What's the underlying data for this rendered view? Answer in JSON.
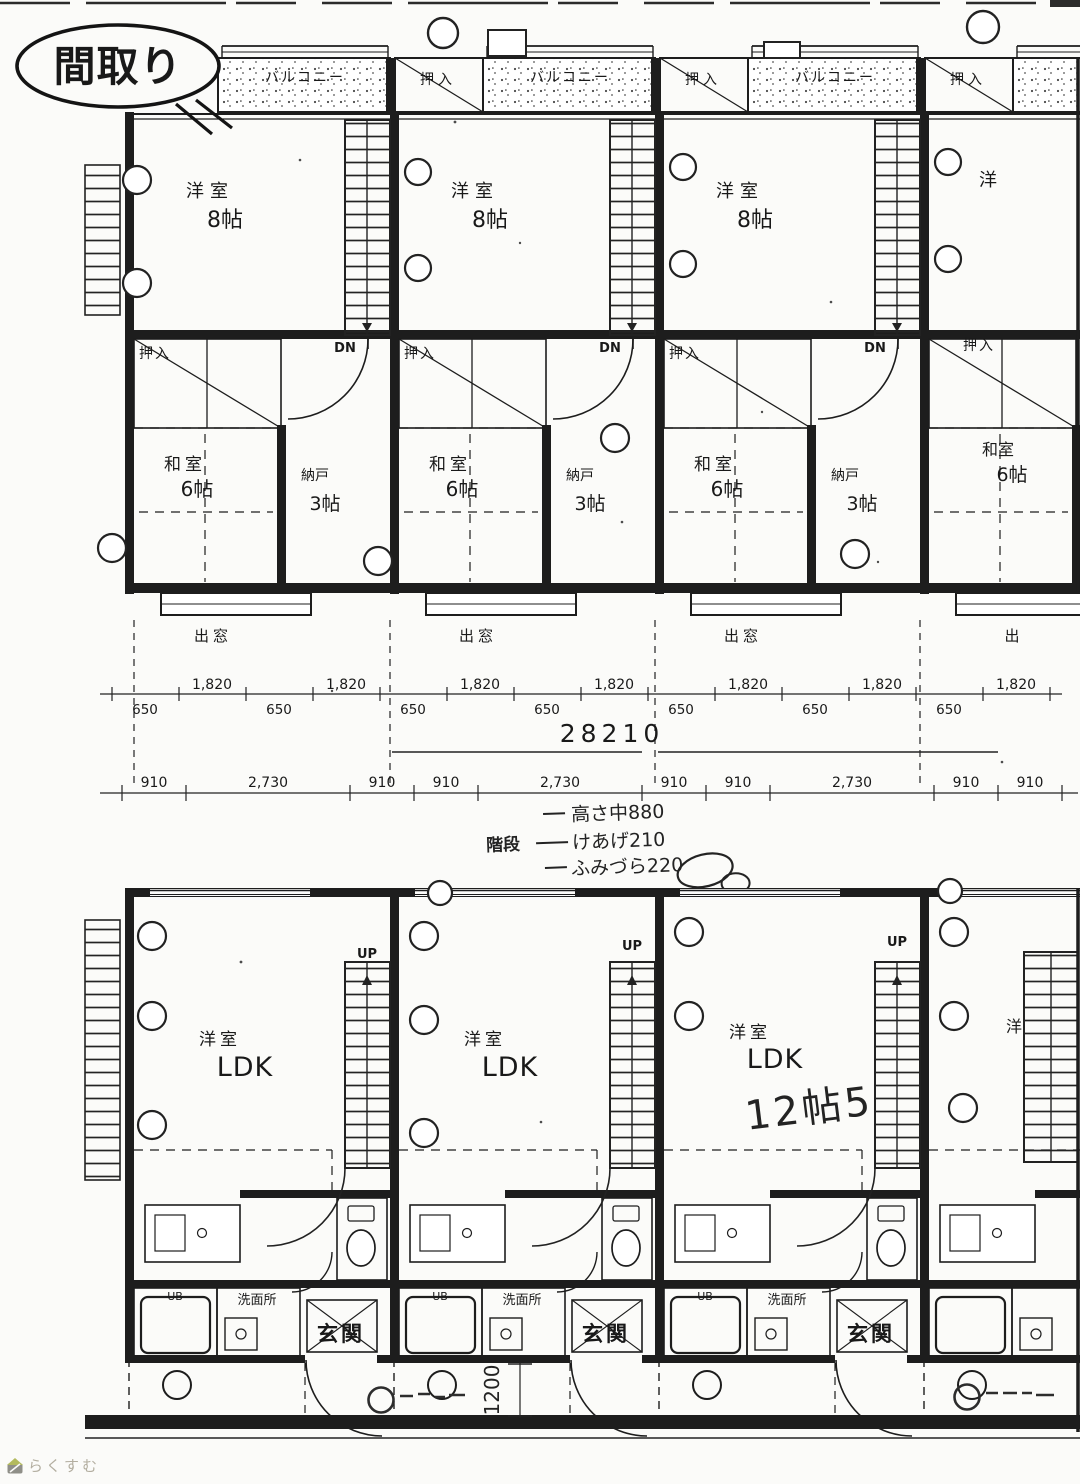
{
  "balloon": {
    "title": "間取り"
  },
  "upper": {
    "balconies": [
      "バルコニー",
      "バルコニー",
      "バルコニー"
    ],
    "top_closets": [
      "押入",
      "押入",
      "押入"
    ],
    "units": [
      {
        "room": "洋室",
        "size": "8帖",
        "dn": "DN",
        "closet": "押入",
        "washitsu": "和室",
        "washitsu_size": "6帖",
        "storage": "納戸",
        "storage_size": "3帖",
        "bay": "出窓"
      },
      {
        "room": "洋室",
        "size": "8帖",
        "dn": "DN",
        "closet": "押入",
        "washitsu": "和室",
        "washitsu_size": "6帖",
        "storage": "納戸",
        "storage_size": "3帖",
        "bay": "出窓"
      },
      {
        "room": "洋室",
        "size": "8帖",
        "dn": "DN",
        "closet": "押入",
        "washitsu": "和室",
        "washitsu_size": "6帖",
        "storage": "納戸",
        "storage_size": "3帖",
        "bay": "出窓"
      },
      {
        "room": "洋",
        "closet": "押入",
        "washitsu": "和室",
        "washitsu_size": "6帖",
        "bay": "出"
      }
    ]
  },
  "dims": {
    "row1_top": [
      "1,820",
      "1,820",
      "1,820",
      "1,820",
      "1,820",
      "1,820",
      "1,820"
    ],
    "row1_bottom": [
      "650",
      "650",
      "650",
      "650",
      "650",
      "650",
      "650"
    ],
    "total": "28210",
    "row2": [
      "910",
      "2,730",
      "910",
      "910",
      "2,730",
      "910",
      "910",
      "2,730",
      "910",
      "910"
    ]
  },
  "notes": {
    "header": "階段",
    "line1": "高さ中880",
    "line2": "けあげ210",
    "line3": "ふみづら220"
  },
  "lower": {
    "units": [
      {
        "room": "洋室",
        "ldk": "LDK",
        "up": "UP",
        "ub": "UB",
        "wash": "洗面所",
        "entrance": "玄関"
      },
      {
        "room": "洋室",
        "ldk": "LDK",
        "up": "UP",
        "ub": "UB",
        "wash": "洗面所",
        "entrance": "玄関"
      },
      {
        "room": "洋室",
        "ldk": "LDK",
        "up": "UP",
        "ub": "UB",
        "wash": "洗面所",
        "entrance": "玄関",
        "hand_note": "12帖5"
      },
      {
        "room": "洋"
      }
    ],
    "hand_dim": "1200"
  },
  "watermark": {
    "brand": "らくすむ"
  }
}
